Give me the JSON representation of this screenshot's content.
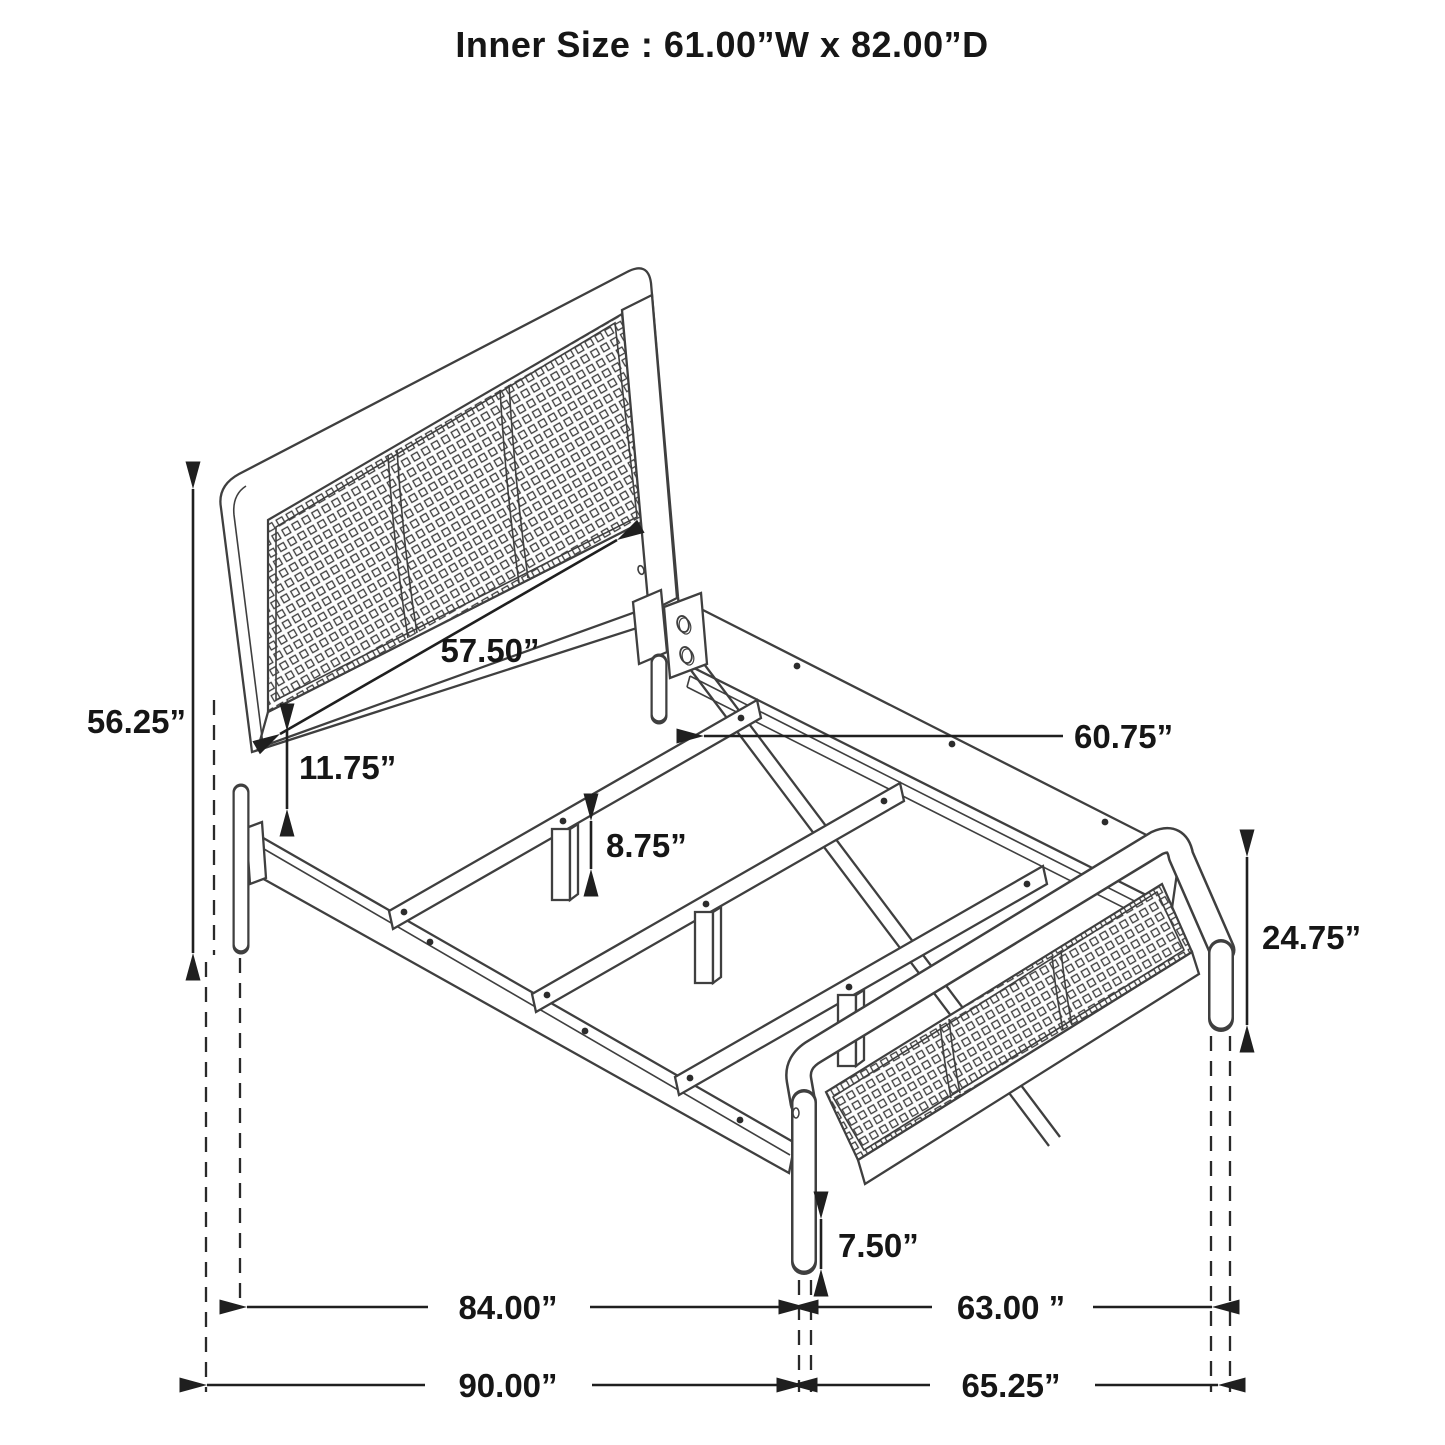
{
  "title": "Inner Size : 61.00”W x 82.00”D",
  "diagram": {
    "type": "furniture dimension drawing",
    "subject": "cane panel bed frame, perspective view with dimension arrows",
    "dimensions": {
      "headboard_height": "56.25”",
      "headboard_rail_length": "57.50”",
      "rail_clearance": "11.75”",
      "slat_length": "60.75”",
      "slat_leg_height": "8.75”",
      "footboard_height": "24.75”",
      "footboard_leg_height": "7.50”",
      "side_rail_length": "84.00”",
      "footboard_span": "63.00 ”",
      "overall_length": "90.00”",
      "overall_width": "65.25”"
    }
  },
  "colors": {
    "line": "#3f3f3f",
    "dimension": "#1f1f1f",
    "text": "#161616",
    "background": "#ffffff"
  }
}
